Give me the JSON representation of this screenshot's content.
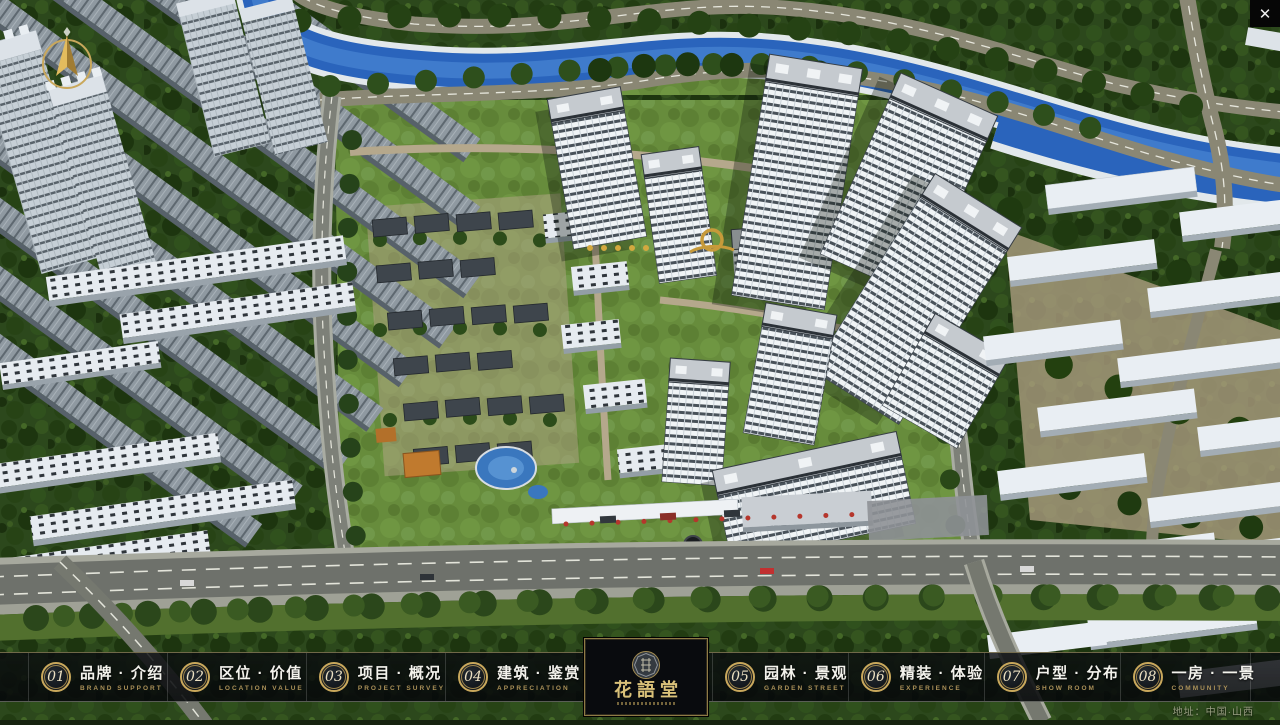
{
  "app": {
    "close_icon": "✕"
  },
  "nav": {
    "items": [
      {
        "num": "01",
        "title": "品牌 · 介绍",
        "subtitle": "BRAND SUPPORT"
      },
      {
        "num": "02",
        "title": "区位 · 价值",
        "subtitle": "LOCATION VALUE"
      },
      {
        "num": "03",
        "title": "项目 · 概况",
        "subtitle": "PROJECT SURVEY"
      },
      {
        "num": "04",
        "title": "建筑 · 鉴赏",
        "subtitle": "APPRECIATION"
      },
      {
        "num": "05",
        "title": "园林 · 景观",
        "subtitle": "GARDEN STREET"
      },
      {
        "num": "06",
        "title": "精装 · 体验",
        "subtitle": "EXPERIENCE"
      },
      {
        "num": "07",
        "title": "户型 · 分布",
        "subtitle": "SHOW ROOM"
      },
      {
        "num": "08",
        "title": "一房 · 一景",
        "subtitle": "COMMUNITY"
      }
    ],
    "logo": {
      "title": "花語堂"
    }
  },
  "footer": {
    "address": "地址：中国·山西"
  },
  "colors": {
    "gold_accent": "#c9a85c",
    "bar_background": "#0a0c0f",
    "river_blue": "#2a64bc"
  }
}
